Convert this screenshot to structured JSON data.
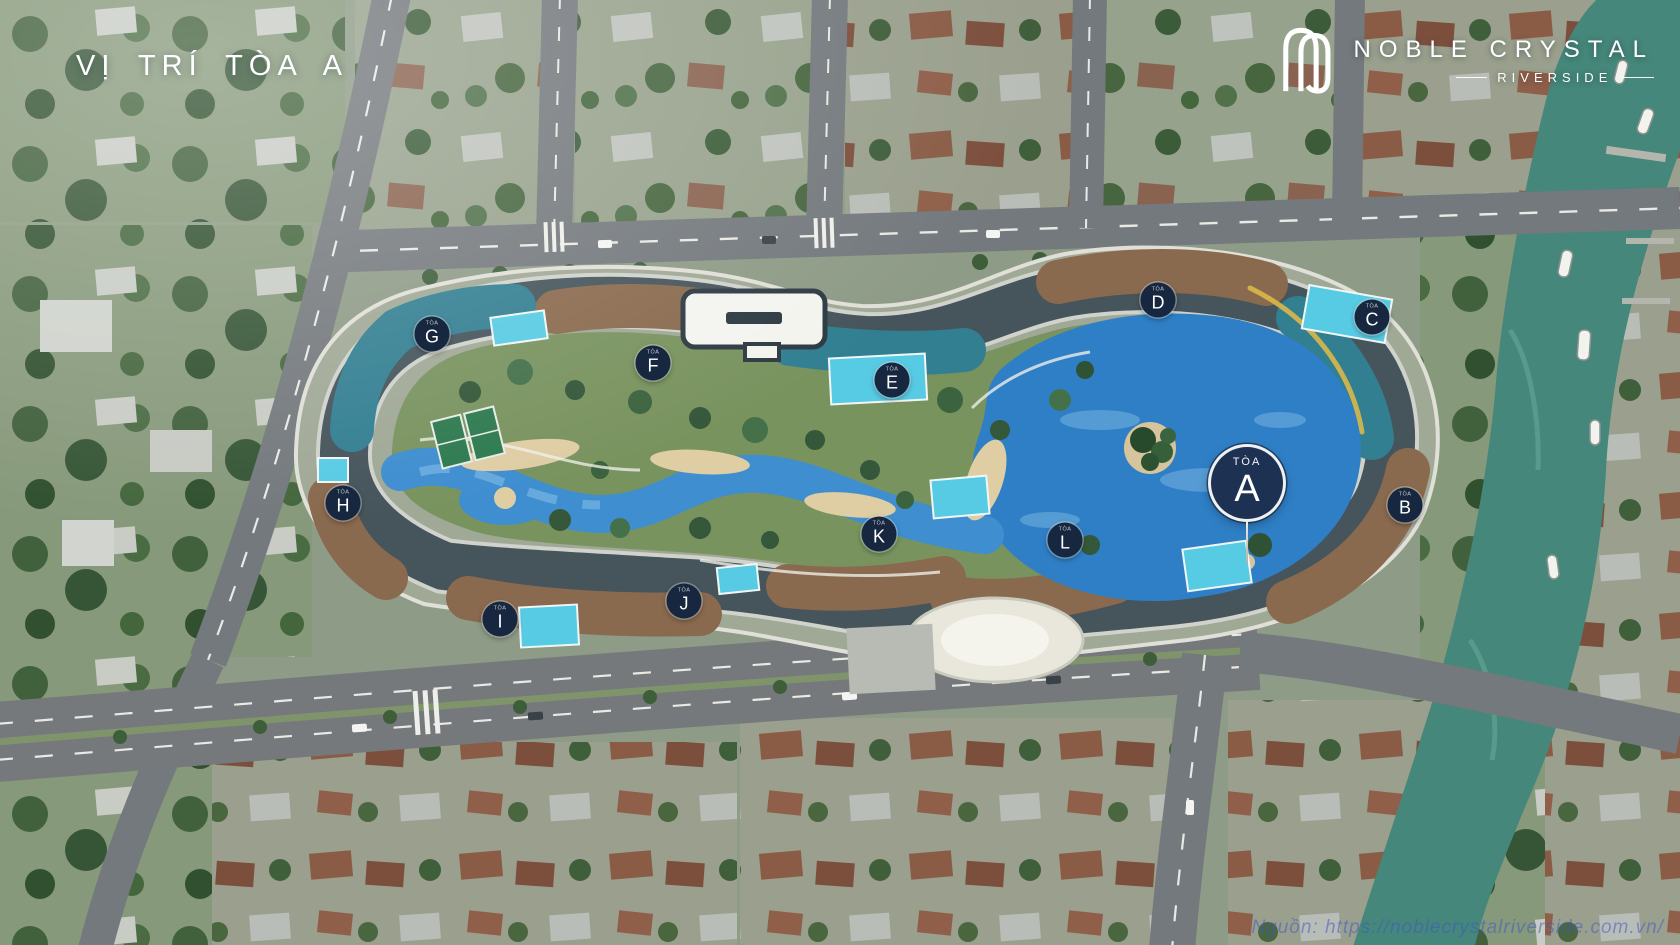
{
  "header": {
    "title": "VỊ TRÍ TÒA A"
  },
  "brand": {
    "name": "NOBLE CRYSTAL",
    "subtitle": "RIVERSIDE",
    "logo_icon": "noble-crystal-monogram",
    "text_color": "#ffffff"
  },
  "map": {
    "description": "Aerial masterplan render of Noble Crystal Riverside showing location of Tower A",
    "highlighted_tower": "A",
    "marker_sub_label": "TÒA",
    "towers": [
      "A",
      "B",
      "C",
      "D",
      "E",
      "F",
      "G",
      "H",
      "I",
      "J",
      "K",
      "L"
    ],
    "markers": [
      {
        "letter": "A",
        "x": 1247,
        "y": 483,
        "primary": true
      },
      {
        "letter": "B",
        "x": 1405,
        "y": 505
      },
      {
        "letter": "C",
        "x": 1372,
        "y": 317
      },
      {
        "letter": "D",
        "x": 1158,
        "y": 300
      },
      {
        "letter": "E",
        "x": 892,
        "y": 380
      },
      {
        "letter": "F",
        "x": 653,
        "y": 363
      },
      {
        "letter": "G",
        "x": 432,
        "y": 334
      },
      {
        "letter": "H",
        "x": 343,
        "y": 503
      },
      {
        "letter": "I",
        "x": 500,
        "y": 619
      },
      {
        "letter": "J",
        "x": 684,
        "y": 601
      },
      {
        "letter": "K",
        "x": 879,
        "y": 534
      },
      {
        "letter": "L",
        "x": 1065,
        "y": 540
      }
    ],
    "colors": {
      "marker_bg": "#16273f",
      "marker_primary_bg": "#1d3153",
      "marker_text": "#ffffff",
      "lake_water": "#2f7fc6",
      "river_water": "#45877a",
      "accent_pool": "#58cbe4"
    }
  },
  "footer": {
    "source_note": "Nguồn: https://noblecrystalriverside.com.vn/"
  }
}
